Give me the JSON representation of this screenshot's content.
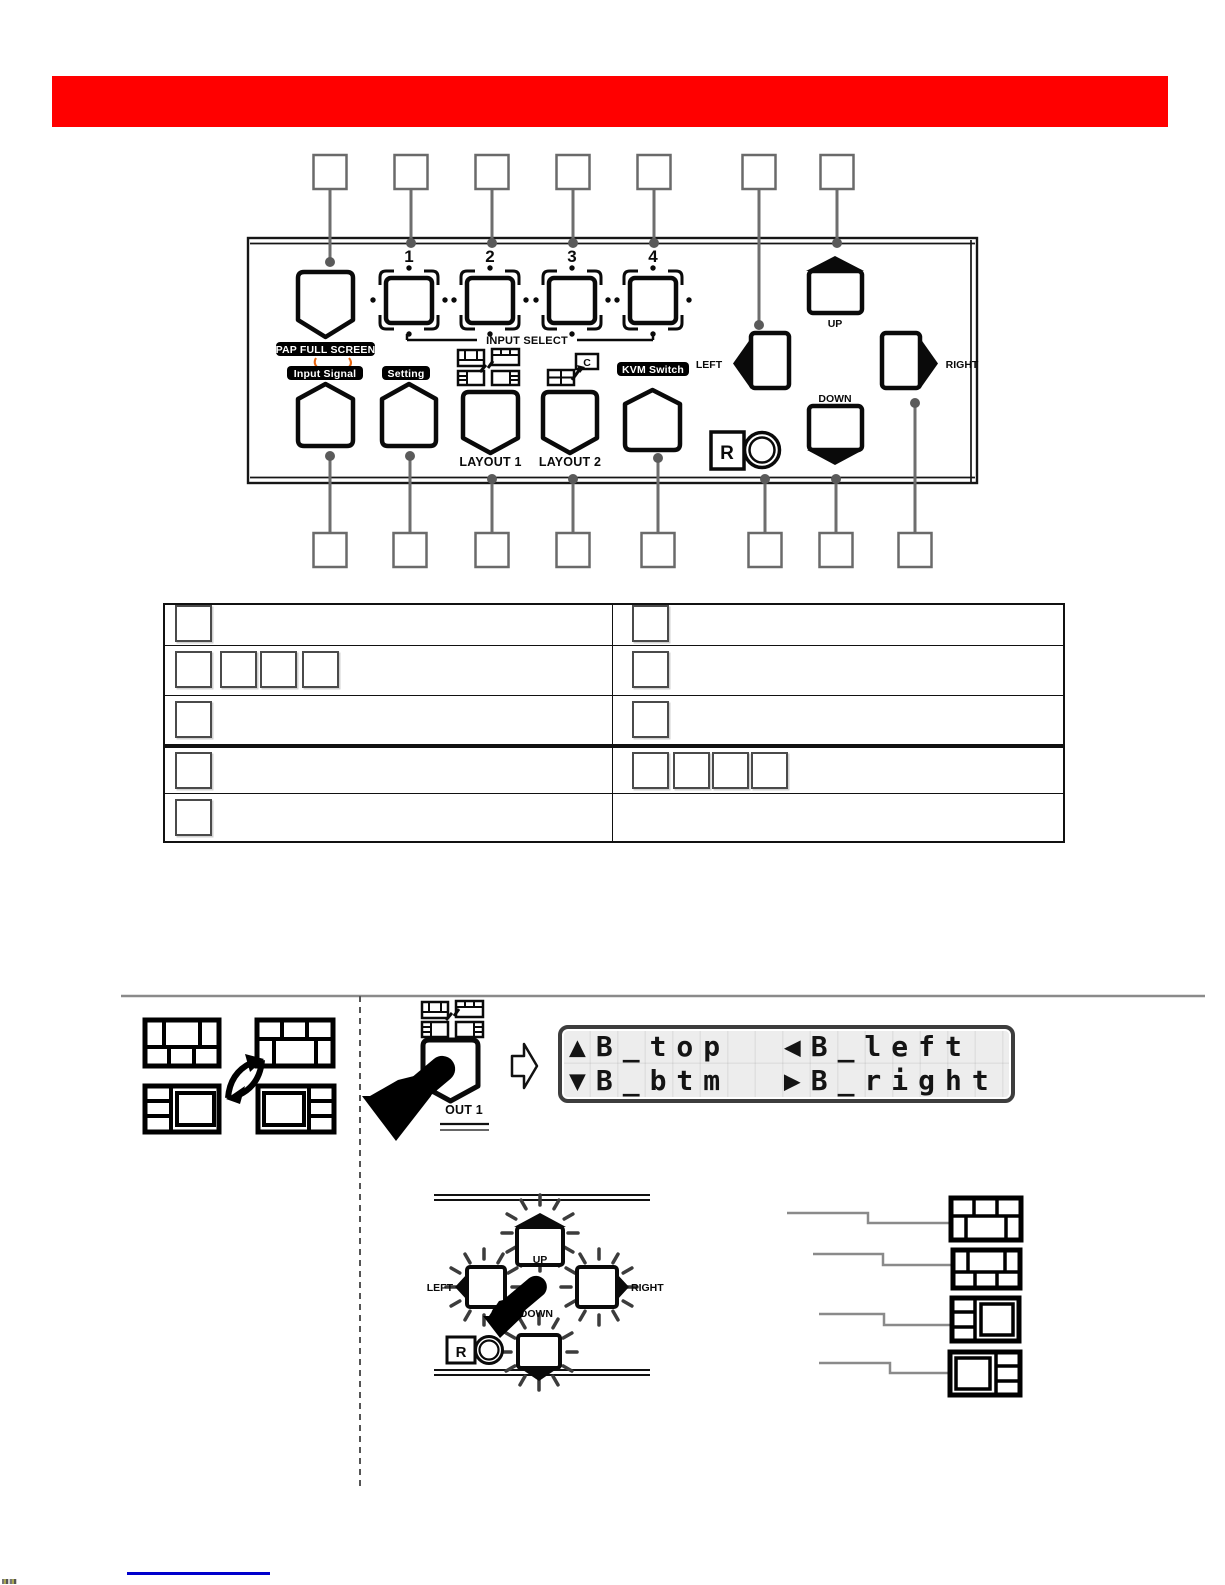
{
  "banner": {
    "color": "#ff0000"
  },
  "panel": {
    "pap_full_screen_label": "PAP FULL SCREEN",
    "input_select_label": "INPUT SELECT",
    "input_numbers": [
      "1",
      "2",
      "3",
      "4"
    ],
    "input_signal_label": "Input Signal",
    "setting_label": "Setting",
    "layout1_label": "LAYOUT 1",
    "layout2_label": "LAYOUT 2",
    "layout2_icon_letter": "C",
    "kvm_switch_label": "KVM Switch",
    "up_label": "UP",
    "down_label": "DOWN",
    "left_label": "LEFT",
    "right_label": "RIGHT",
    "ir_logo_letter": "R"
  },
  "callouts": {
    "top_boxes": 7,
    "bottom_boxes": 8
  },
  "table": {
    "rows": [
      {
        "left_boxes": 1,
        "right_boxes": 1
      },
      {
        "left_boxes": 4,
        "right_boxes": 1
      },
      {
        "left_boxes": 1,
        "right_boxes": 1
      },
      {
        "left_boxes": 1,
        "right_boxes": 4
      },
      {
        "left_boxes": 1,
        "right_boxes": 0
      }
    ]
  },
  "instructions": {
    "lcd": {
      "line1": "▲B_top  ◀B_left",
      "line2": "▼B_btm  ▶B_right"
    },
    "pressed_button_label": "OUT 1",
    "cluster": {
      "up_label": "UP",
      "down_label": "DOWN",
      "left_label": "LEFT",
      "right_label": "RIGHT",
      "ir_logo_letter": "R"
    }
  },
  "footer": {
    "underline_color": "#0000cc"
  }
}
